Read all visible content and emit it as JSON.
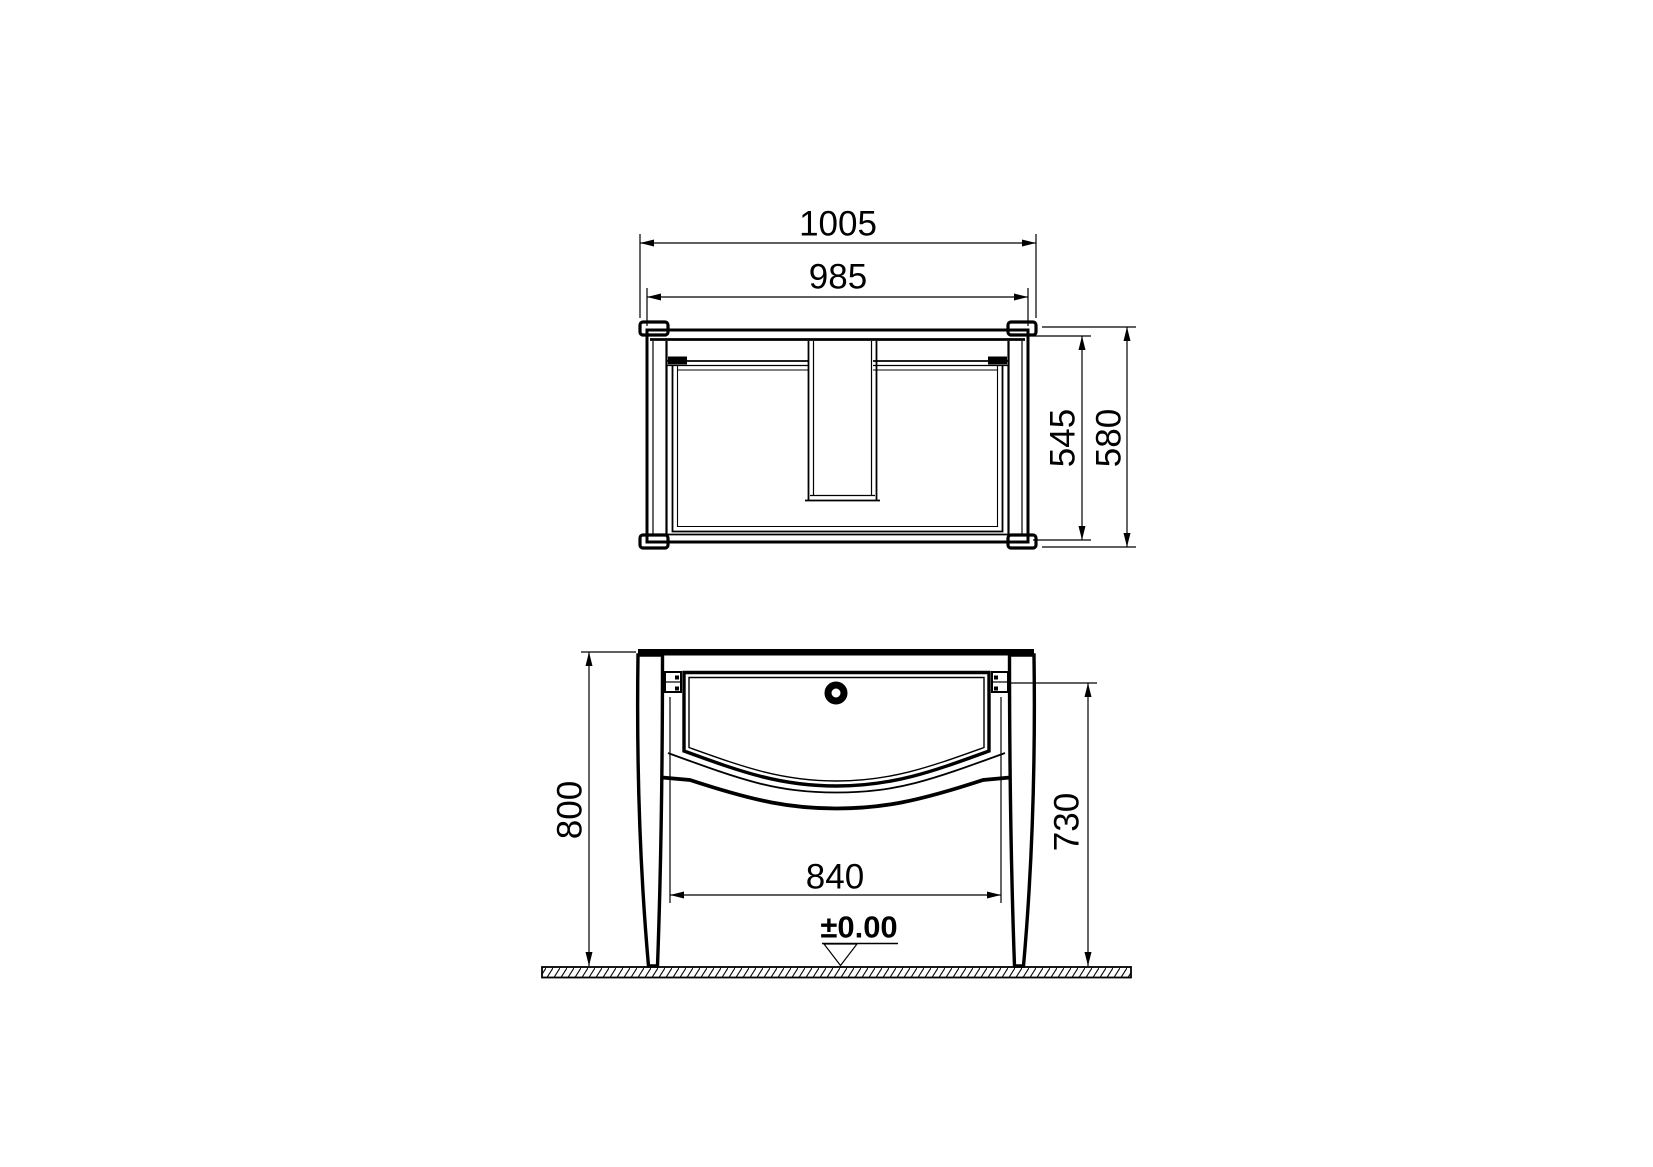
{
  "page": {
    "background_color": "#ffffff",
    "line_color": "#000000"
  },
  "plan_view": {
    "overall_width": "1005",
    "carcass_width": "985",
    "carcass_depth": "545",
    "overall_depth": "580"
  },
  "front_view": {
    "overall_height": "800",
    "underside_height": "730",
    "inner_width": "840",
    "datum_level": "±0.00"
  }
}
